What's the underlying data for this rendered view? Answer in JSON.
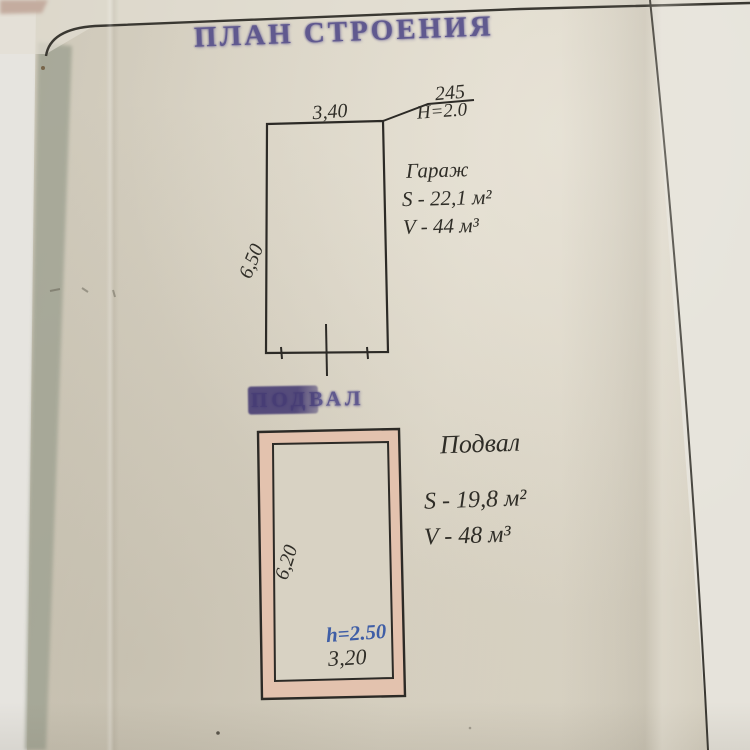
{
  "page": {
    "title_stamp": "ПЛАН СТРОЕНИЯ",
    "section_stamp": "ПОДВАЛ"
  },
  "garage": {
    "label": "Гараж",
    "area": "S - 22,1 м²",
    "volume": "V - 44 м³",
    "width_dim": "3,40",
    "height_dim": "6,50",
    "note_number": "245",
    "note_height": "H=2.0"
  },
  "basement": {
    "label": "Подвал",
    "area": "S - 19,8 м²",
    "volume": "V - 48 м³",
    "height_dim": "6,20",
    "width_dim": "3,20",
    "ceiling_height": "h=2.50"
  },
  "colors": {
    "stamp_ink": "#57508b",
    "pen_ink": "#2f2d27",
    "blue_ink": "#3f5ea6",
    "wall_fill": "#e3c2ae",
    "paper": "#d7d1c2"
  }
}
